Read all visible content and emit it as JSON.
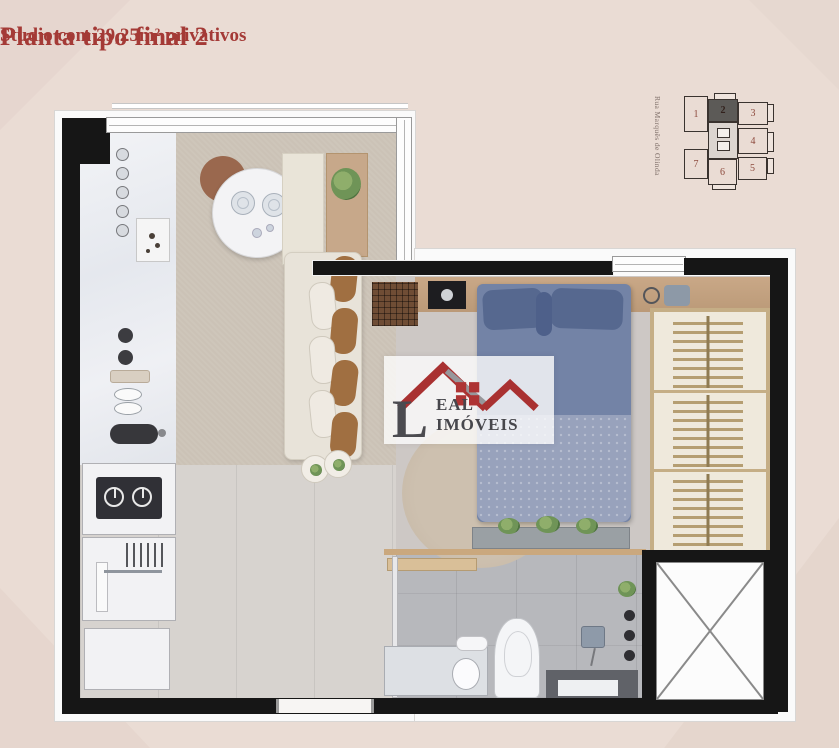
{
  "title": "Planta tipo final 2",
  "subtitle": "Studio com 29,25m² privativos",
  "keyplan": {
    "street_label": "Rua Marquês de Olinda",
    "highlighted_unit": "2",
    "units": [
      {
        "label": "1"
      },
      {
        "label": "2"
      },
      {
        "label": "3"
      },
      {
        "label": "4"
      },
      {
        "label": "5"
      },
      {
        "label": "6"
      },
      {
        "label": "7"
      }
    ]
  },
  "watermark": {
    "brand_initial": "L",
    "brand_rest": "EAL IMÓVEIS"
  },
  "colors": {
    "background": "#eadcd4",
    "accent_red": "#a43a36",
    "wall_black": "#161616",
    "logo_red": "#a93131",
    "bed_blue": "#7383a6",
    "wardrobe_tan": "#c5ae86"
  }
}
